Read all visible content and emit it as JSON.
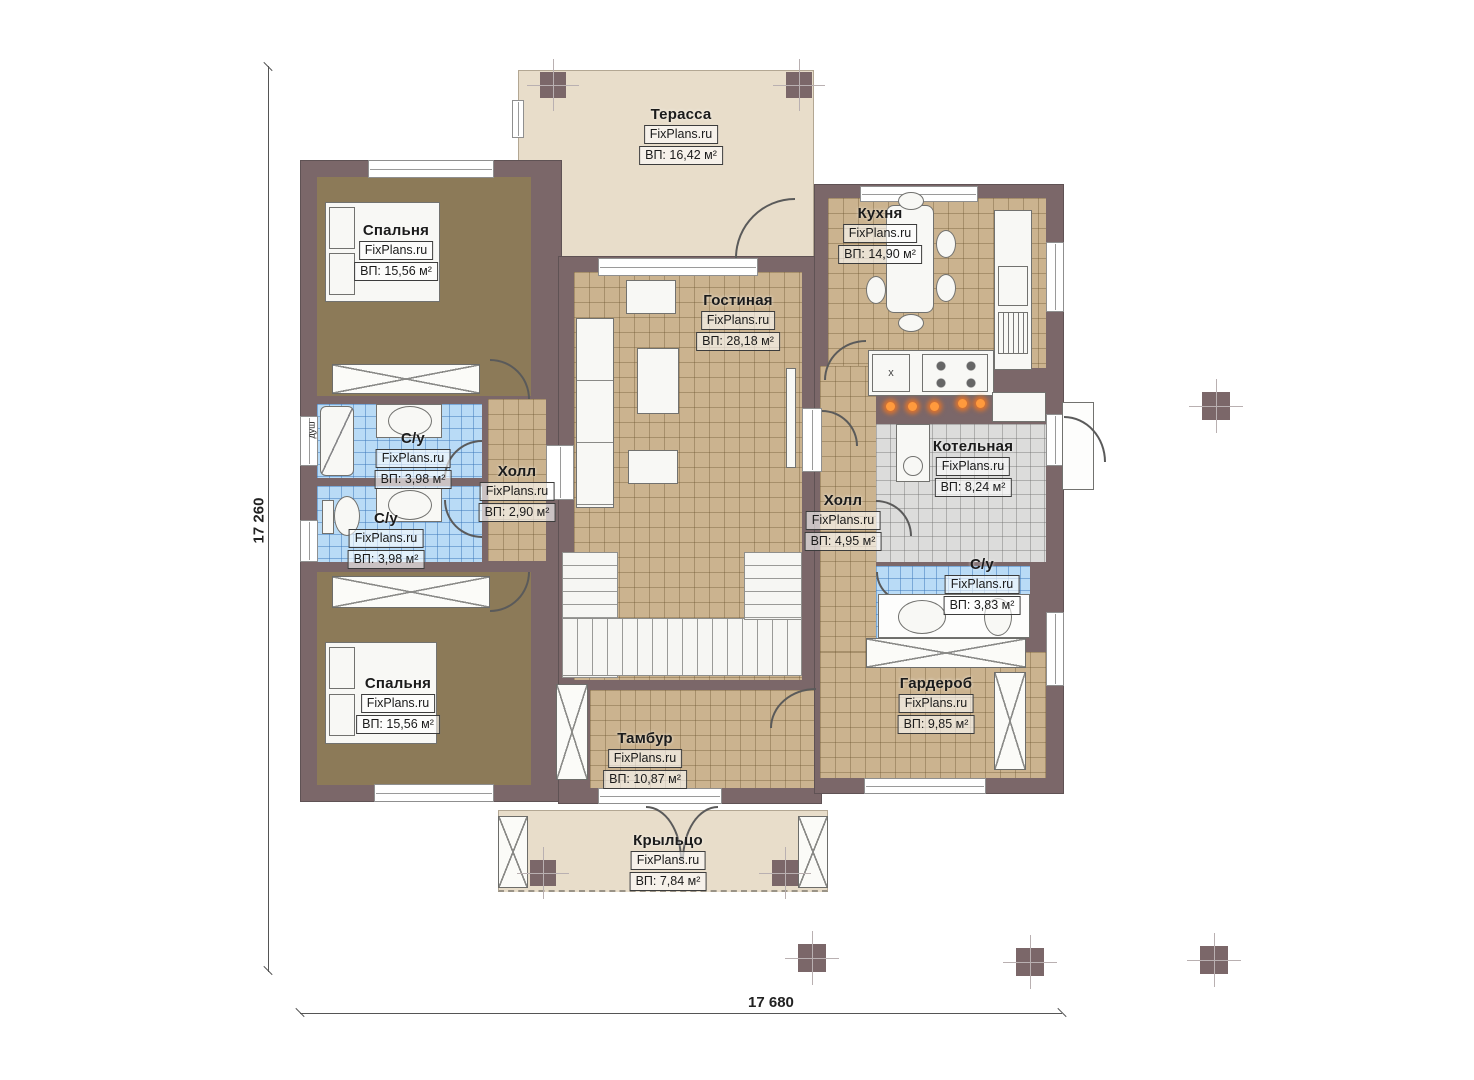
{
  "brand": "FixPlans.ru",
  "dimensions": {
    "vertical": "17 260",
    "horizontal": "17 680"
  },
  "annotations": {
    "shower": "душ",
    "sink_mark": "x"
  },
  "colors": {
    "wall": "#7b6769",
    "tile_tan": "#cbb38f",
    "tile_blue": "#b9dbf6",
    "tile_gray": "#dcdcdb",
    "terrace_beige": "#e8ddca",
    "bedroom_brown": "#8c7a58",
    "burner_orange": "#ff9a3d"
  },
  "rooms": [
    {
      "name": "Терасса",
      "area": "ВП: 16,42 м²"
    },
    {
      "name": "Спальня",
      "area": "ВП: 15,56 м²"
    },
    {
      "name": "Кухня",
      "area": "ВП: 14,90 м²"
    },
    {
      "name": "Гостиная",
      "area": "ВП: 28,18 м²"
    },
    {
      "name": "С/у",
      "area": "ВП: 3,98 м²"
    },
    {
      "name": "Холл",
      "area": "ВП: 2,90 м²"
    },
    {
      "name": "С/у",
      "area": "ВП: 3,98 м²"
    },
    {
      "name": "Холл",
      "area": "ВП: 4,95 м²"
    },
    {
      "name": "Котельная",
      "area": "ВП: 8,24 м²"
    },
    {
      "name": "С/у",
      "area": "ВП: 3,83 м²"
    },
    {
      "name": "Спальня",
      "area": "ВП: 15,56 м²"
    },
    {
      "name": "Гардероб",
      "area": "ВП: 9,85 м²"
    },
    {
      "name": "Тамбур",
      "area": "ВП: 10,87 м²"
    },
    {
      "name": "Крыльцо",
      "area": "ВП: 7,84 м²"
    }
  ]
}
